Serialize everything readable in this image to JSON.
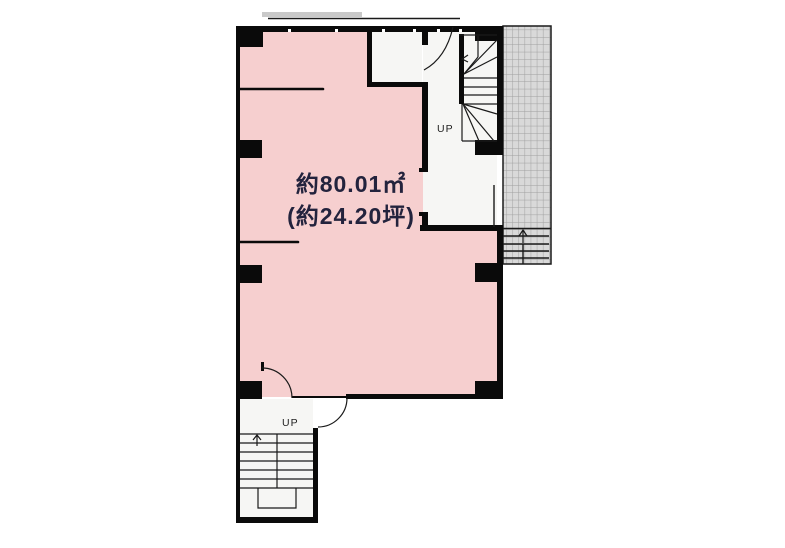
{
  "floor_plan": {
    "area_label": {
      "line1": "約80.01㎡",
      "line2": "(約24.20坪)"
    },
    "upper_stair": {
      "label": "UP"
    },
    "lower_stair": {
      "label": "UP"
    }
  },
  "colors": {
    "background": "#ffffff",
    "main_room_fill": "#f6cfcf",
    "service_room_fill": "#f6f6f4",
    "wall": "#0a0a0a",
    "balcony_fill": "#d9d9d9",
    "balcony_grid_line": "#a0a0a0",
    "area_text": "#23233d",
    "awning": "#c9c9c9"
  }
}
